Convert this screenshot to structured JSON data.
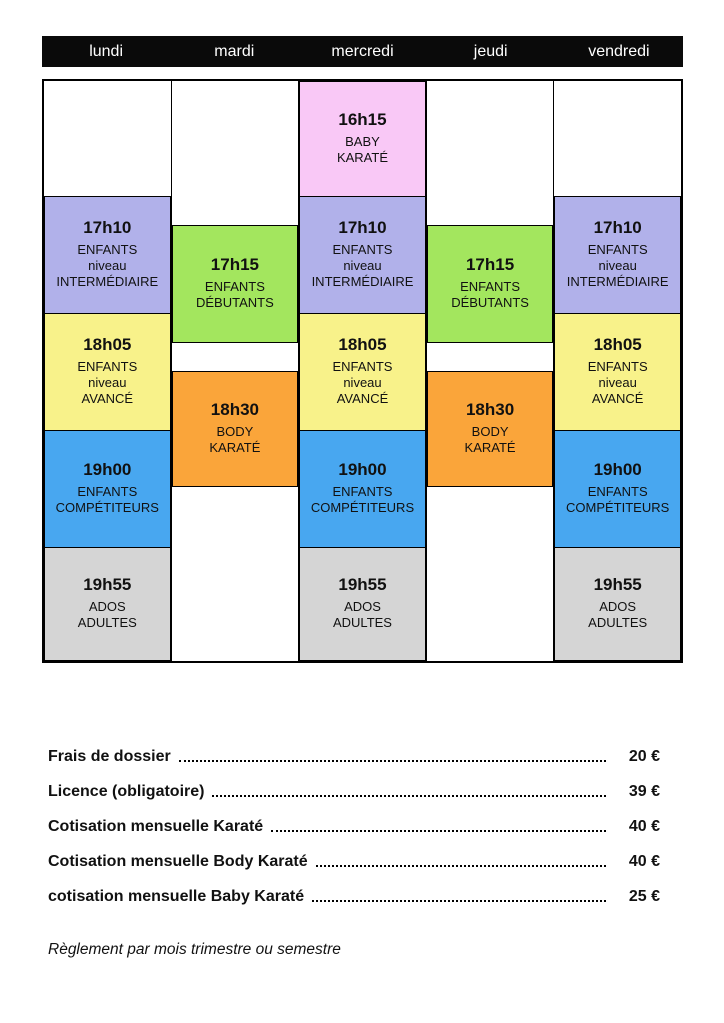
{
  "header": {
    "days": [
      "lundi",
      "mardi",
      "mercredi",
      "jeudi",
      "vendredi"
    ]
  },
  "classes": {
    "baby": {
      "time": "16h15",
      "lines": [
        "BABY",
        "KARATÉ"
      ],
      "color": "#f9c8f6"
    },
    "inter": {
      "time": "17h10",
      "lines": [
        "ENFANTS",
        "niveau",
        "INTERMÉDIAIRE"
      ],
      "color": "#b1b1ea"
    },
    "deb": {
      "time": "17h15",
      "lines": [
        "ENFANTS",
        "DÉBUTANTS"
      ],
      "color": "#a3e65e"
    },
    "av": {
      "time": "18h05",
      "lines": [
        "ENFANTS",
        "niveau",
        "AVANCÉ"
      ],
      "color": "#f8f28a"
    },
    "body": {
      "time": "18h30",
      "lines": [
        "BODY",
        "KARATÉ"
      ],
      "color": "#faa53a"
    },
    "comp": {
      "time": "19h00",
      "lines": [
        "ENFANTS",
        "COMPÉTITEURS"
      ],
      "color": "#48a7f0"
    },
    "ados": {
      "time": "19h55",
      "lines": [
        "ADOS",
        "ADULTES"
      ],
      "color": "#d5d5d5"
    }
  },
  "pricing": {
    "items": [
      {
        "label": "Frais de dossier",
        "price": "20 €"
      },
      {
        "label": "Licence (obligatoire)",
        "price": "39 €"
      },
      {
        "label": "Cotisation mensuelle Karaté",
        "price": "40 €"
      },
      {
        "label": "Cotisation mensuelle Body Karaté",
        "price": "40 €"
      },
      {
        "label": "cotisation mensuelle Baby Karaté",
        "price": "25 €"
      }
    ]
  },
  "note": "Règlement par mois trimestre ou semestre"
}
